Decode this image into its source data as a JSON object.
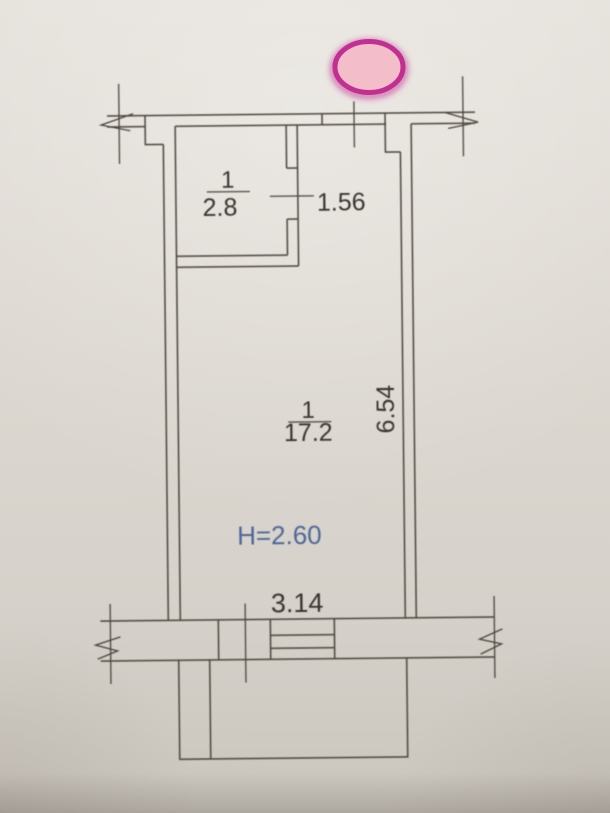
{
  "plan": {
    "rooms": {
      "storage": {
        "number": "1",
        "area": "2.8"
      },
      "living": {
        "number": "1",
        "area": "17.2"
      }
    },
    "dimensions": {
      "opening_width": "1.56",
      "length": "6.54",
      "width": "3.14",
      "ceiling_height": "H=2.60"
    },
    "marker": {
      "shape": "highlight-ellipse",
      "fill": "#f4bdca",
      "stroke": "#c12f92"
    },
    "colors": {
      "paper": "#ddd8d1",
      "ink": "#4a453d",
      "label_ink": "#38352f",
      "height_label_ink": "#4d6899"
    }
  }
}
